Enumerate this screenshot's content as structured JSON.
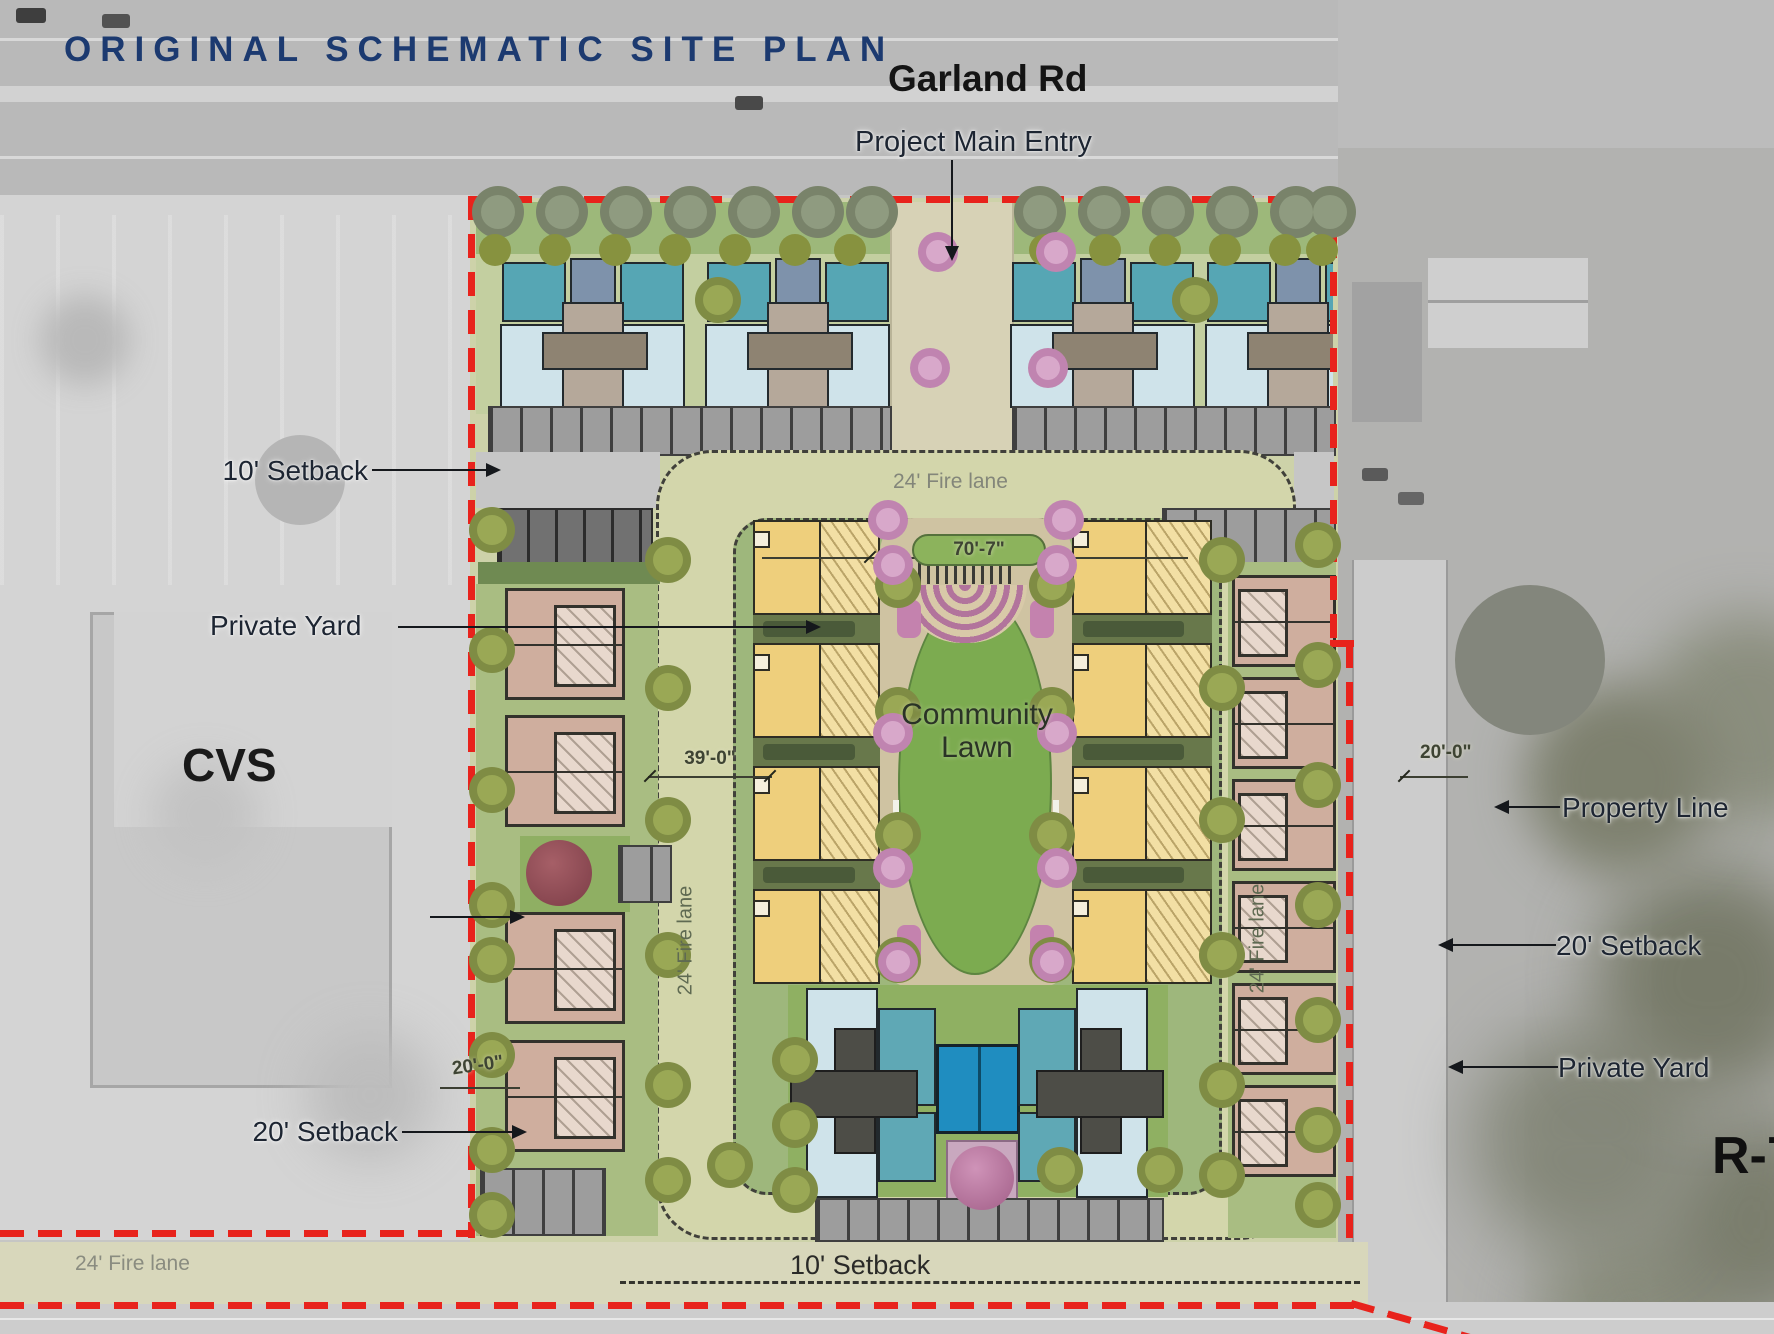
{
  "title": "ORIGINAL SCHEMATIC SITE PLAN",
  "labels": {
    "garland_rd": "Garland Rd",
    "project_main_entry": "Project Main Entry",
    "setback_10_left": "10' Setback",
    "private_yard_left": "Private Yard",
    "cvs": "CVS",
    "community_lawn_line1": "Community",
    "community_lawn_line2": "Lawn",
    "property_line": "Property Line",
    "setback_20_right": "20' Setback",
    "private_yard_right": "Private Yard",
    "zoning_r7": "R-7",
    "setback_20_bottom_left": "20' Setback",
    "setback_10_bottom": "10' Setback",
    "fire_lane_top": "24' Fire lane",
    "fire_lane_bottom_left": "24' Fire lane",
    "fire_lane_left_vertical": "24' Fire lane",
    "fire_lane_right_vertical": "24' Fire lane"
  },
  "dimensions": {
    "community_lawn_width": "70'-7\"",
    "fire_lane_spacing": "39'-0\"",
    "setback_right": "20'-0\"",
    "setback_left_bottom": "20'-0\""
  },
  "colors": {
    "title_text": "#1c3a70",
    "property_line_red": "#e8231c",
    "fire_lane_tan": "#d3d6ab",
    "lawn_green": "#7cab50",
    "pool_blue": "#1f8dc0",
    "townhouse_yellow": "#eecf7c",
    "townhouse_brown": "#cfae9e",
    "roof_teal": "#56a6b4",
    "roof_light_blue": "#cfe3ea"
  }
}
